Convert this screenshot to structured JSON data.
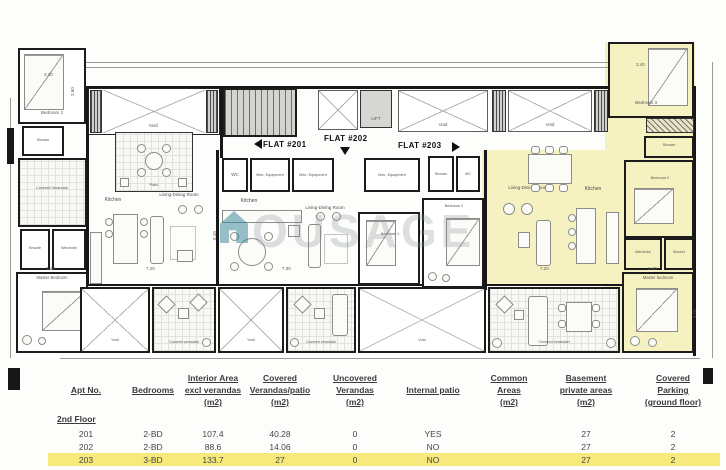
{
  "plan": {
    "flats": {
      "f201": "FLAT #201",
      "f202": "FLAT #202",
      "f203": "FLAT #203"
    },
    "rooms": {
      "yard": "Yard",
      "void": "Void",
      "lift": "LIFT",
      "bedroom1": "Bedroom 1",
      "bedroom2": "Bedroom 2",
      "bedroom3": "Bedroom 3",
      "master_bedroom": "Master Bedroom",
      "master_bedroom_lc": "Master bedroom",
      "kitchen": "Kitchen",
      "living_dining": "Living-Dining Room",
      "covered_verandah": "Covered Verandah",
      "covered_verandah_lc": "Covered verandah",
      "patio": "Patio",
      "shower": "Shower",
      "wardrobe": "Wardrobe",
      "ensuite": "Ensuite",
      "wc": "WC",
      "mec": "Mec. Equipment"
    },
    "dims": {
      "d340": "3.40",
      "d360": "3.60",
      "d720": "7.20",
      "d730": "7.30",
      "d510": "5.10",
      "d470": "4.70",
      "d140": "1.40"
    },
    "watermark": "OUSAGE"
  },
  "table": {
    "headers": {
      "apt": [
        "Apt No."
      ],
      "bedrooms": [
        "Bedrooms"
      ],
      "interior": [
        "Interior Area",
        "excl verandas",
        "(m2)"
      ],
      "covered": [
        "Covered",
        "Verandas/patio",
        "(m2)"
      ],
      "uncovered": [
        "Uncovered",
        "Verandas",
        "(m2)"
      ],
      "internal": [
        "Internal patio"
      ],
      "common": [
        "Common",
        "Areas",
        "(m2)"
      ],
      "basement": [
        "Basement",
        "private areas",
        "(m2)"
      ],
      "parking": [
        "Covered",
        "Parking",
        "(ground floor)"
      ]
    },
    "section": "2nd Floor",
    "rows": [
      [
        "201",
        "2-BD",
        "107.4",
        "40.28",
        "0",
        "YES",
        "",
        "27",
        "2"
      ],
      [
        "202",
        "2-BD",
        "88.6",
        "14.06",
        "0",
        "NO",
        "",
        "27",
        "2"
      ],
      [
        "203",
        "3-BD",
        "133.7",
        "27",
        "0",
        "NO",
        "",
        "27",
        "2"
      ]
    ]
  },
  "colors": {
    "flat_highlight": "#f6f1c0",
    "row_highlight": "#f7e97c",
    "watermark_teal": "#2e7f93"
  }
}
